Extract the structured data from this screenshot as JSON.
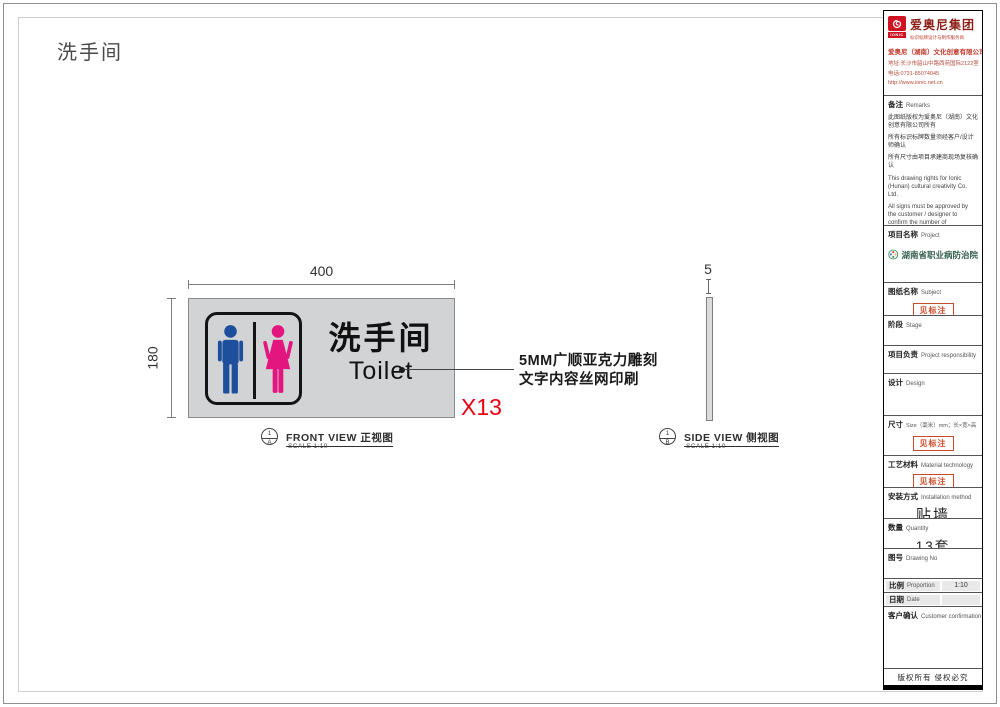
{
  "page": {
    "title": "洗手间"
  },
  "colors": {
    "male": "#1e4f9c",
    "female": "#e3157f",
    "sign_bg": "#d2d3d5",
    "quantity_red": "#e60012",
    "brand_red": "#cf1322",
    "stamp_red": "#cc4a28",
    "hospital_green": "#35604e"
  },
  "front_view": {
    "sign": {
      "cn": "洗手间",
      "en": "Toilet"
    },
    "dims": {
      "width": "400",
      "height": "180"
    },
    "annotation": {
      "line1": "5MM广顺亚克力雕刻",
      "line2": "文字内容丝网印刷"
    },
    "quantity_mark": "X13",
    "label": {
      "num": "1",
      "ref": "A",
      "title": "FRONT VIEW 正视图",
      "scale": "SCALE 1:10"
    }
  },
  "side_view": {
    "dim": "5",
    "label": {
      "num": "1",
      "ref": "B",
      "title": "SIDE VIEW 侧视图",
      "scale": "SCALE 1:10"
    }
  },
  "title_block": {
    "brand": {
      "name": "爱奥尼集团",
      "logo_text": "IONIC",
      "tagline": "标识标牌设计与制作服务商",
      "company": "爱奥尼（湖南）文化创意有限公司",
      "address": "地址:长沙市韶山中路西苑国际2122室",
      "phone": "电话:0731-85074045",
      "website": "http://www.ionic.net.cn"
    },
    "remarks": {
      "label_cn": "备注",
      "label_en": "Remarks",
      "cn": [
        "此图纸版权为爱奥尼（湖南）文化创意有限公司所有",
        "所有标识标牌数量须经客户/设计师确认",
        "所有尺寸由项目承建商现场复核确认"
      ],
      "en": [
        "This drawing rights for Ionic (Hunan) cultural creativity Co. Ltd.",
        "All signs must be approved by the customer / designer to confirm the number of",
        "All dimensions by the project contractors on-site review confirmed"
      ]
    },
    "project": {
      "label_cn": "项目名称",
      "label_en": "Project",
      "value": "湖南省职业病防治院"
    },
    "subject": {
      "label_cn": "图纸名称",
      "label_en": "Subject",
      "value": "见标注"
    },
    "stage": {
      "label_cn": "阶段",
      "label_en": "Stage"
    },
    "responsibility": {
      "label_cn": "项目负责",
      "label_en": "Project responsibility"
    },
    "design": {
      "label_cn": "设计",
      "label_en": "Design"
    },
    "size": {
      "label_cn": "尺寸",
      "label_en": "Size（毫米）mm；长×宽×高",
      "value": "见标注"
    },
    "material": {
      "label_cn": "工艺材料",
      "label_en": "Material technology",
      "value": "见标注"
    },
    "installation": {
      "label_cn": "安装方式",
      "label_en": "Installation method",
      "value": "贴墙"
    },
    "quantity": {
      "label_cn": "数量",
      "label_en": "Quantity",
      "value": "13套"
    },
    "drawing_no": {
      "label_cn": "图号",
      "label_en": "Drawing No"
    },
    "proportion": {
      "label_cn": "比例",
      "label_en": "Proportion",
      "value": "1:10"
    },
    "date": {
      "label_cn": "日期",
      "label_en": "Date",
      "value": ""
    },
    "customer": {
      "label_cn": "客户确认",
      "label_en": "Customer confirmation"
    },
    "copyright": "版权所有  侵权必究"
  }
}
